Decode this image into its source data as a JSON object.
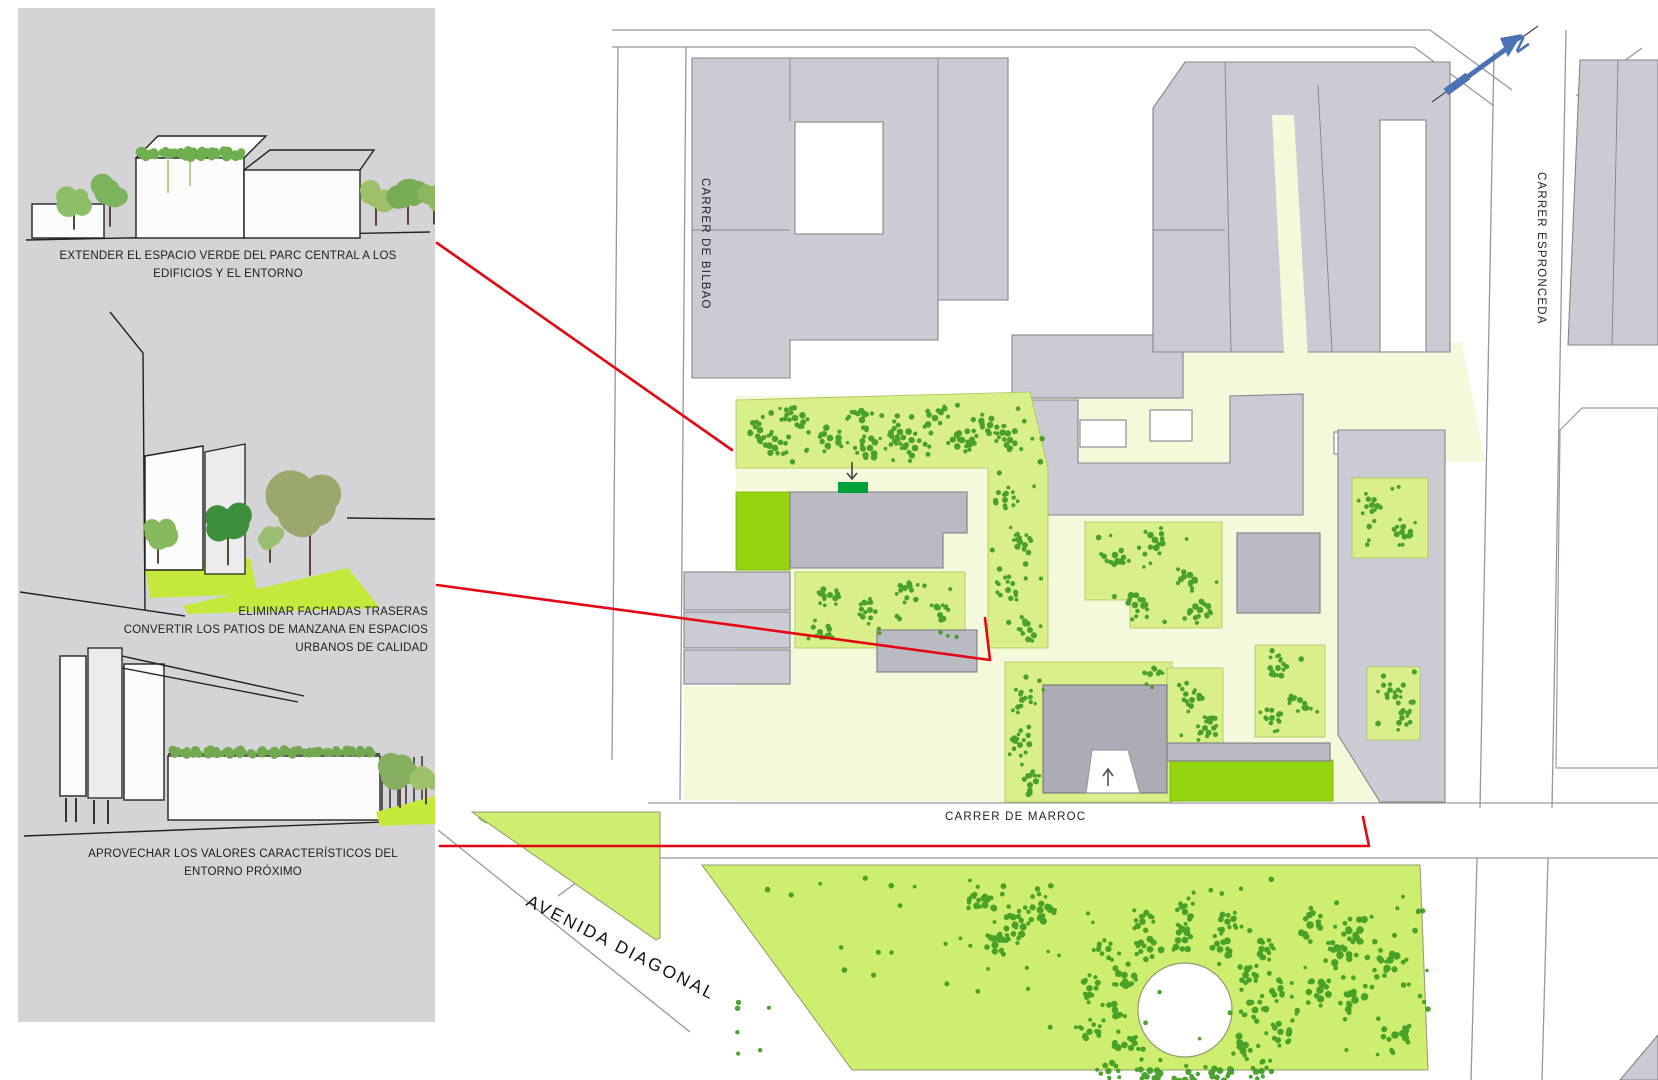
{
  "panel": {
    "captions": {
      "c1": "EXTENDER EL ESPACIO VERDE DEL PARC CENTRAL A LOS EDIFICIOS Y EL ENTORNO",
      "c2a": "ELIMINAR FACHADAS TRASERAS",
      "c2b": "CONVERTIR LOS PATIOS DE MANZANA EN ESPACIOS URBANOS DE CALIDAD",
      "c3": "APROVECHAR LOS VALORES CARACTERÍSTICOS DEL ENTORNO PRÓXIMO"
    }
  },
  "map": {
    "street_labels": {
      "bilbao": "CARRER DE BILBAO",
      "espronceda": "CARRER ESPRONCEDA",
      "marroc": "CARRER DE MARROC",
      "diagonal": "AVENIDA DIAGONAL"
    },
    "icons": {
      "north_arrow": "north-arrow-icon"
    },
    "colors": {
      "panel_bg": "#d4d4d6",
      "block_gray": "#cbccd3",
      "building_gray": "#b9bac2",
      "light_green": "#d9ef8a",
      "bright_green": "#94d50f",
      "pale_path": "#f3f9da",
      "park_green": "#cdee6e",
      "tree_green": "#3e9b21",
      "entrance_green": "#00a13a",
      "annotation_red": "#e30613",
      "north_blue": "#4a72b4"
    }
  }
}
